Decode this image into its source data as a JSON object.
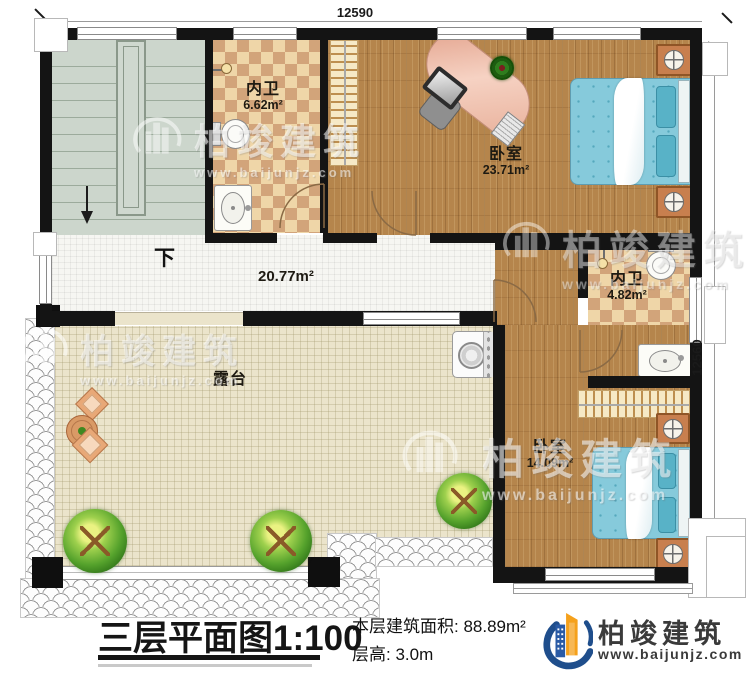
{
  "plan": {
    "dimensions": {
      "top_width": "12590",
      "right_height": "12560"
    },
    "rooms": {
      "bath1": {
        "name": "内卫",
        "area": "6.62m²"
      },
      "bedroom1": {
        "name": "卧室",
        "area": "23.71m²"
      },
      "bath2": {
        "name": "内卫",
        "area": "4.82m²"
      },
      "bedroom2": {
        "name": "卧室",
        "area": "14.09m²"
      },
      "hall": {
        "area": "20.77m²",
        "stair_direction": "下"
      },
      "terrace": {
        "name": "露台"
      }
    }
  },
  "watermark": {
    "company": "柏竣建筑",
    "website": "www.baijunjz.com"
  },
  "footer": {
    "title": "三层平面图",
    "scale": "1:100",
    "area_line": "本层建筑面积: 88.89m²",
    "height_line": "层高: 3.0m",
    "company": "柏竣建筑",
    "website": "www.baijunjz.com"
  },
  "colors": {
    "wall": "#141414",
    "wood_floor": "#b5854c",
    "tile_light": "#efd6a8",
    "tile_dark": "#d2a47a",
    "stair_floor": "#ccd6cc",
    "terrace_floor": "#ebe4cb",
    "bed_blue": "#86cadb",
    "brand_blue": "#20508e",
    "brand_orange": "#f5a01d"
  }
}
